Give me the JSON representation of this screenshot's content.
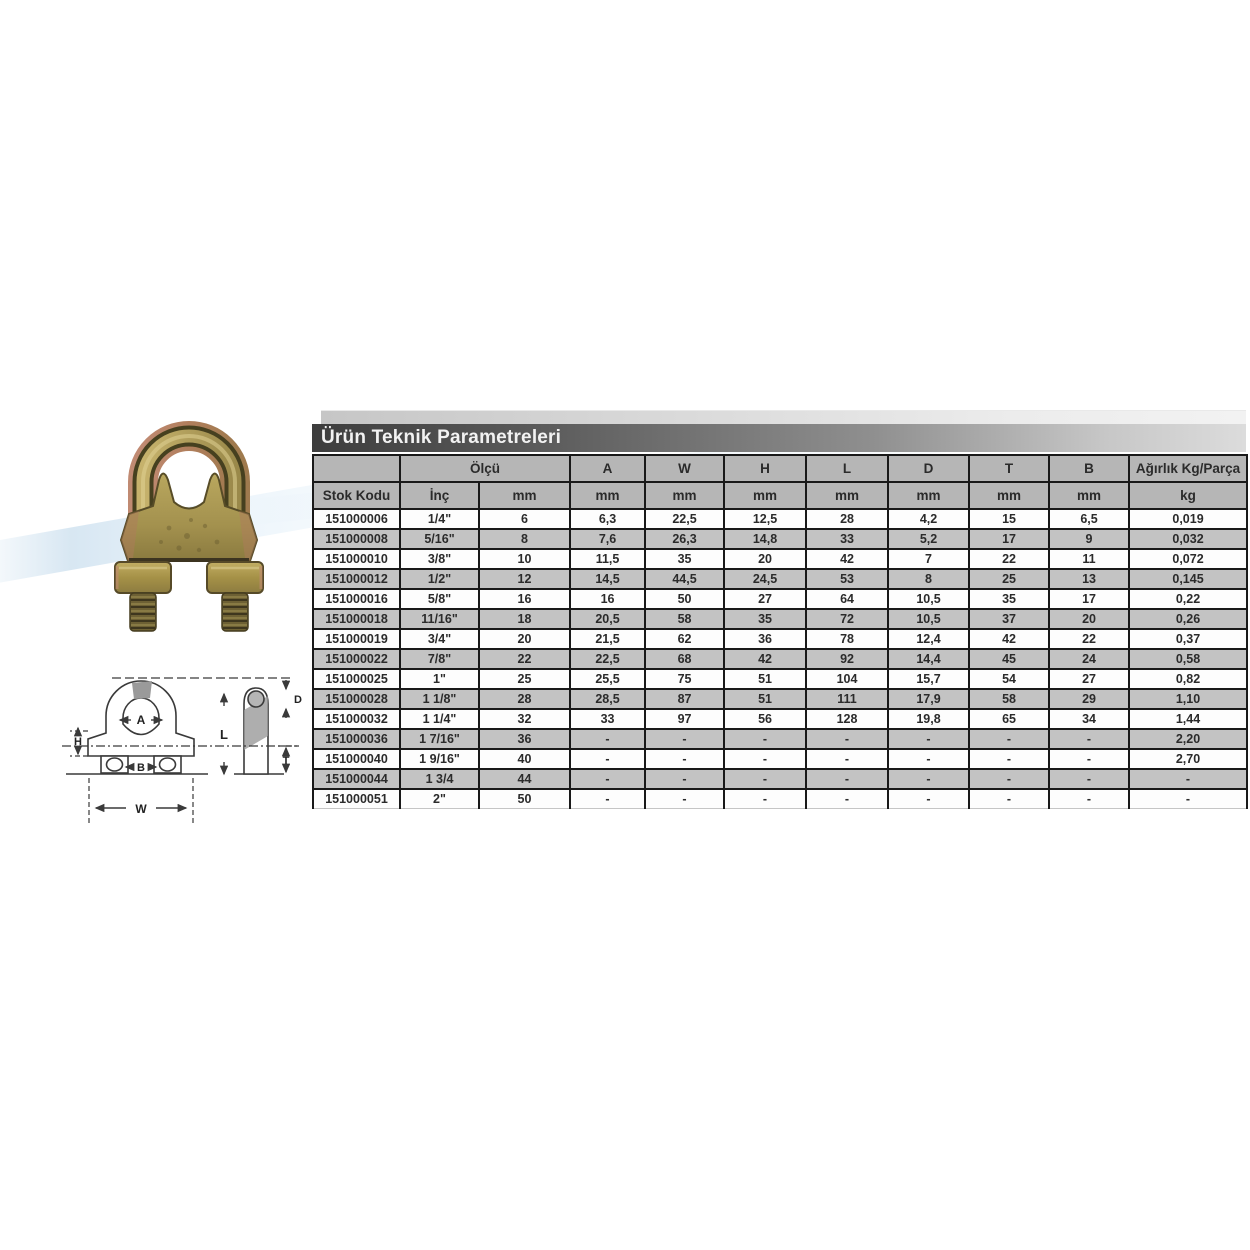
{
  "header": {
    "title": "Ürün Teknik Parametreleri"
  },
  "colors": {
    "title_bar_left": "#3d3d3d",
    "title_bar_right": "#dcdcdc",
    "table_header_bg": "#b6b6b6",
    "row_alt_bg": "#c3c3c3",
    "row_bg": "#fdfdfd",
    "table_border": "#191919",
    "wave_blue": "#b7d3e8",
    "product_brass": "#b3a15a",
    "product_copper": "#b8806b"
  },
  "product": {
    "photo": "wire-rope-clip-photo"
  },
  "diagram": {
    "labels": {
      "A": "A",
      "H": "H",
      "B": "B",
      "W": "W",
      "L": "L",
      "D": "D",
      "T": "T"
    }
  },
  "table": {
    "group_header": [
      {
        "label": "",
        "span": 1
      },
      {
        "label": "Ölçü",
        "span": 2
      },
      {
        "label": "A",
        "span": 1
      },
      {
        "label": "W",
        "span": 1
      },
      {
        "label": "H",
        "span": 1
      },
      {
        "label": "L",
        "span": 1
      },
      {
        "label": "D",
        "span": 1
      },
      {
        "label": "T",
        "span": 1
      },
      {
        "label": "B",
        "span": 1
      },
      {
        "label": "Ağırlık Kg/Parça",
        "span": 1
      }
    ],
    "unit_header": [
      "Stok Kodu",
      "İnç",
      "mm",
      "mm",
      "mm",
      "mm",
      "mm",
      "mm",
      "mm",
      "mm",
      "kg"
    ],
    "rows": [
      [
        "151000006",
        "1/4\"",
        "6",
        "6,3",
        "22,5",
        "12,5",
        "28",
        "4,2",
        "15",
        "6,5",
        "0,019"
      ],
      [
        "151000008",
        "5/16\"",
        "8",
        "7,6",
        "26,3",
        "14,8",
        "33",
        "5,2",
        "17",
        "9",
        "0,032"
      ],
      [
        "151000010",
        "3/8\"",
        "10",
        "11,5",
        "35",
        "20",
        "42",
        "7",
        "22",
        "11",
        "0,072"
      ],
      [
        "151000012",
        "1/2\"",
        "12",
        "14,5",
        "44,5",
        "24,5",
        "53",
        "8",
        "25",
        "13",
        "0,145"
      ],
      [
        "151000016",
        "5/8\"",
        "16",
        "16",
        "50",
        "27",
        "64",
        "10,5",
        "35",
        "17",
        "0,22"
      ],
      [
        "151000018",
        "11/16\"",
        "18",
        "20,5",
        "58",
        "35",
        "72",
        "10,5",
        "37",
        "20",
        "0,26"
      ],
      [
        "151000019",
        "3/4\"",
        "20",
        "21,5",
        "62",
        "36",
        "78",
        "12,4",
        "42",
        "22",
        "0,37"
      ],
      [
        "151000022",
        "7/8\"",
        "22",
        "22,5",
        "68",
        "42",
        "92",
        "14,4",
        "45",
        "24",
        "0,58"
      ],
      [
        "151000025",
        "1\"",
        "25",
        "25,5",
        "75",
        "51",
        "104",
        "15,7",
        "54",
        "27",
        "0,82"
      ],
      [
        "151000028",
        "1 1/8\"",
        "28",
        "28,5",
        "87",
        "51",
        "111",
        "17,9",
        "58",
        "29",
        "1,10"
      ],
      [
        "151000032",
        "1 1/4\"",
        "32",
        "33",
        "97",
        "56",
        "128",
        "19,8",
        "65",
        "34",
        "1,44"
      ],
      [
        "151000036",
        "1 7/16\"",
        "36",
        "-",
        "-",
        "-",
        "-",
        "-",
        "-",
        "-",
        "2,20"
      ],
      [
        "151000040",
        "1 9/16\"",
        "40",
        "-",
        "-",
        "-",
        "-",
        "-",
        "-",
        "-",
        "2,70"
      ],
      [
        "151000044",
        "1 3/4",
        "44",
        "-",
        "-",
        "-",
        "-",
        "-",
        "-",
        "-",
        "-"
      ],
      [
        "151000051",
        "2\"",
        "50",
        "-",
        "-",
        "-",
        "-",
        "-",
        "-",
        "-",
        "-"
      ]
    ]
  }
}
